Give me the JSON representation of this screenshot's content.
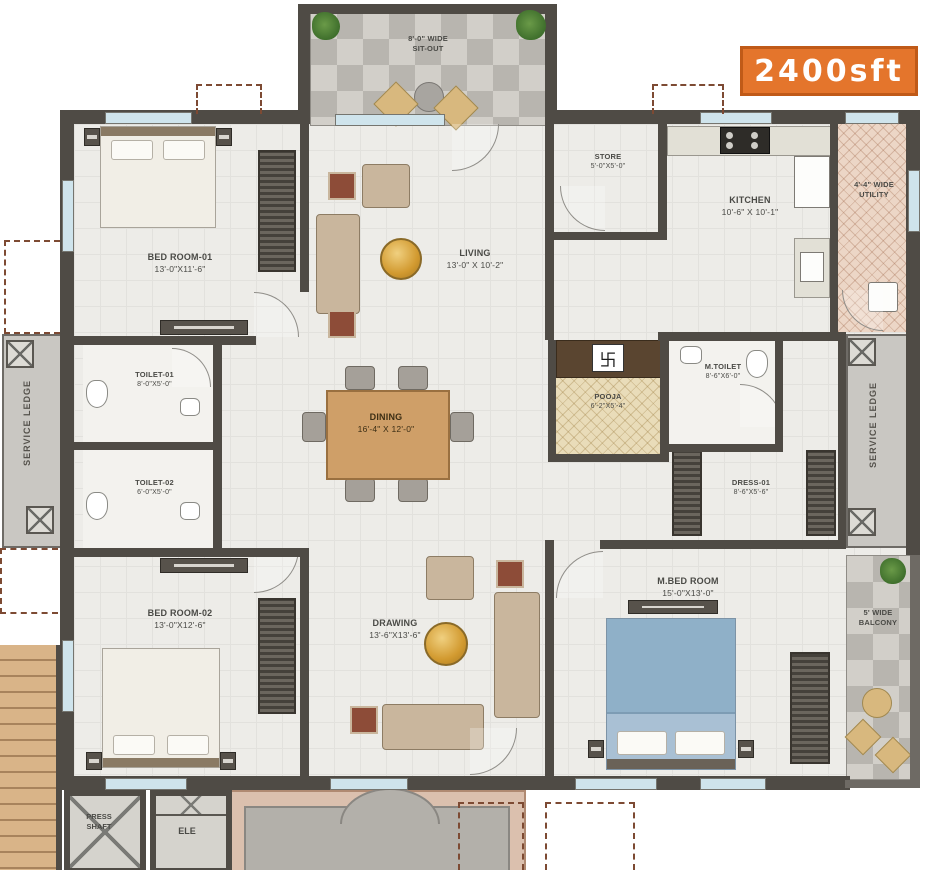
{
  "badge": {
    "label": "2400sft"
  },
  "rooms": {
    "sit_out": {
      "line1": "8'-0\" WIDE",
      "line2": "SIT-OUT"
    },
    "store": {
      "name": "STORE",
      "dims": "5'-0\"X5'-0\""
    },
    "kitchen": {
      "name": "KITCHEN",
      "dims": "10'-6\" X 10'-1\""
    },
    "utility": {
      "line1": "4'-4\" WIDE",
      "line2": "UTILITY"
    },
    "bedroom1": {
      "name": "BED ROOM-01",
      "dims": "13'-0\"X11'-6\""
    },
    "living": {
      "name": "LIVING",
      "dims": "13'-0\" X 10'-2\""
    },
    "toilet1": {
      "name": "TOILET-01",
      "dims": "8'-0\"X5'-0\""
    },
    "toilet2": {
      "name": "TOILET-02",
      "dims": "6'-0\"X5'-0\""
    },
    "dining": {
      "name": "DINING",
      "dims": "16'-4\" X 12'-0\""
    },
    "pooja": {
      "name": "POOJA",
      "dims": "6'-2\"X5'-4\"",
      "symbol": "卐"
    },
    "m_toilet": {
      "name": "M.TOILET",
      "dims": "8'-6\"X6'-0\""
    },
    "dress1": {
      "name": "DRESS-01",
      "dims": "8'-6\"X5'-6\""
    },
    "service_ledge_left": {
      "name": "SERVICE LEDGE"
    },
    "service_ledge_right": {
      "name": "SERVICE LEDGE"
    },
    "bedroom2": {
      "name": "BED ROOM-02",
      "dims": "13'-0\"X12'-6\""
    },
    "drawing": {
      "name": "DRAWING",
      "dims": "13'-6\"X13'-6\""
    },
    "m_bedroom": {
      "name": "M.BED ROOM",
      "dims": "15'-0\"X13'-0\""
    },
    "balcony": {
      "line1": "5' WIDE",
      "line2": "BALCONY"
    },
    "press_shaft": {
      "line1": "PRESS",
      "line2": "SHAFT"
    },
    "ele": {
      "name": "ELE"
    }
  },
  "colors": {
    "accent": "#e4752c",
    "wall": "#4f4b45",
    "floor": "#edece8",
    "window": "#cfe4ec",
    "overhang_dash": "#7d4a33",
    "pooja_floor": "#e9dcb9",
    "utility_floor": "#ecd6c6",
    "master_bed": "#8fb0c8"
  }
}
